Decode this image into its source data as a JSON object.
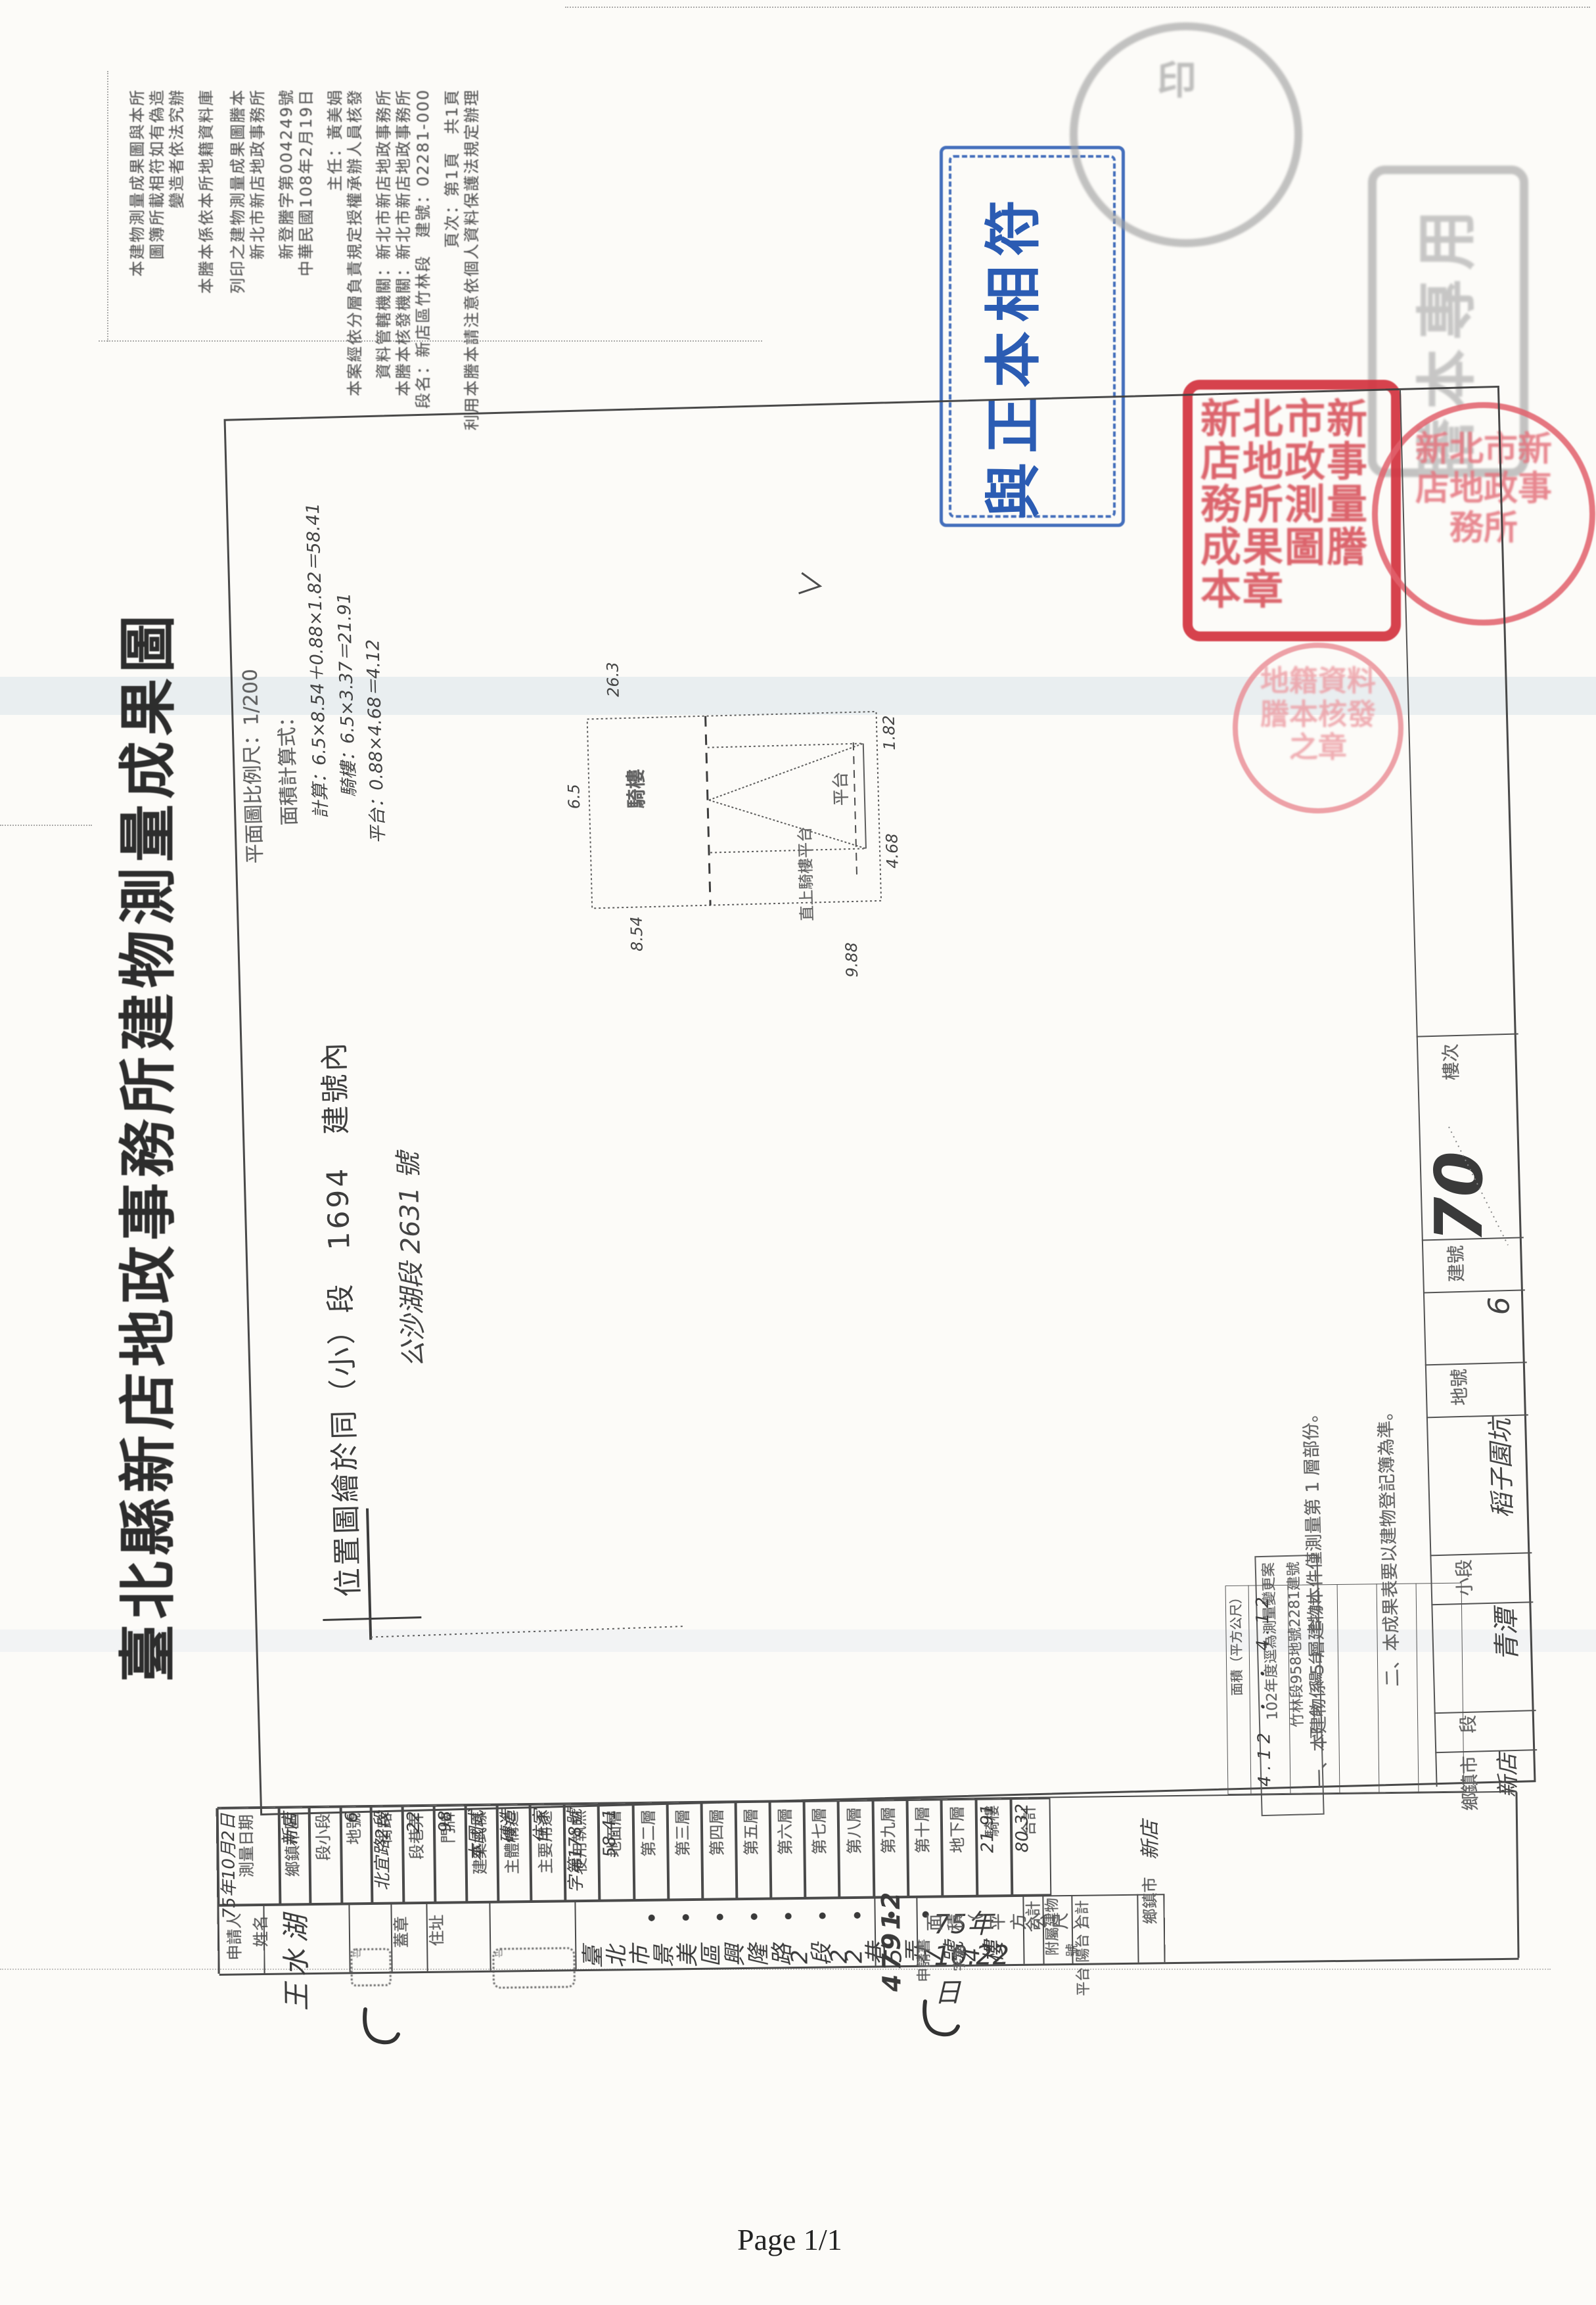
{
  "footer": {
    "page_indicator": "Page 1/1"
  },
  "blue_stamp": {
    "text": "與正本相符",
    "color": "#2b5cb3"
  },
  "title": "臺北縣新店地政事務所建物測量成果圖",
  "certification": {
    "lines": [
      "本建物測量成果圖與本所",
      "圖簿所載相符如有偽造",
      "變造者依法究辦",
      "本謄本係依本所地籍資料庫",
      "列印之建物測量成果圖謄本",
      "新北市新店地政事務所",
      "新登謄字第004249號",
      "中華民國108年2月19日",
      "主任：黃美娟",
      "本案經依分層負責規定授權承辦人員核發",
      "資料管轄機關：新北市新店地政事務所",
      "本謄本核發機關：新北市新店地政事務所",
      "段名：新店區竹林段　建號：02281-000",
      "頁次：第1頁　共1頁",
      "利用本謄本請注意依個人資料保護法規定辦理"
    ]
  },
  "map": {
    "scale_label": "平面圖比例尺：1/200",
    "calc_title": "面積計算式：",
    "calc_lines": [
      "計算：6.5×8.54＋0.88×1.82＝58.41",
      "騎樓：6.5×3.37＝21.91",
      "平台：0.88×4.68＝4.12"
    ],
    "location_line": "位置圖繪於同（小）段　1694　建號內",
    "location_hand": "公沙湖段 2631 號",
    "notes": [
      "一、本建物係 5 層建物本件僅測量第 1 層部份。",
      "二、本成果表要以建物登記簿為準。"
    ],
    "note_box": [
      "102年度逕為測量變更案",
      "竹林段958地號2281建號"
    ],
    "check_mark": "＞"
  },
  "plan": {
    "labels": {
      "arcade": "騎樓",
      "platform": "平台",
      "stair": "直上騎樓平台"
    },
    "dims": {
      "top": "26.3",
      "left": "6.5",
      "bottom_left": "8.54",
      "bottom_right": "9.88",
      "right_top": "1.82",
      "right_mid": "4.68"
    }
  },
  "strip": {
    "cells": [
      {
        "label": "樓次",
        "value": ""
      },
      {
        "label": "建號",
        "value": "70"
      },
      {
        "label": "地號",
        "value": "6"
      },
      {
        "label": "小段",
        "value": "稻子園坑"
      },
      {
        "label": "段",
        "value": "青潭"
      },
      {
        "label": "鄉鎮市",
        "value": "新店"
      }
    ]
  },
  "table": {
    "fields": [
      {
        "label": "測量日期",
        "value": "75年10月2日"
      },
      {
        "label": "鄉鎮市區",
        "value": "新店"
      },
      {
        "label": "段小段",
        "value": ""
      },
      {
        "label": "地號",
        "value": "6"
      },
      {
        "label": "街路",
        "value": "北宜路2段"
      },
      {
        "label": "段巷弄",
        "value": "22"
      },
      {
        "label": "門牌",
        "value": "98"
      },
      {
        "label": "建築式樣",
        "value": "本國式"
      },
      {
        "label": "主體構造",
        "value": "磚造"
      },
      {
        "label": "主要用途",
        "value": "住家"
      },
      {
        "label": "使用執照",
        "value": "字第178號"
      },
      {
        "label": "地面層",
        "value": "58.41"
      },
      {
        "label": "第二層",
        "value": "·"
      },
      {
        "label": "第三層",
        "value": "·"
      },
      {
        "label": "第四層",
        "value": "·"
      },
      {
        "label": "第五層",
        "value": "·"
      },
      {
        "label": "第六層",
        "value": "·"
      },
      {
        "label": "第七層",
        "value": "·"
      },
      {
        "label": "第八層",
        "value": "·"
      },
      {
        "label": "第九層",
        "value": "·"
      },
      {
        "label": "第十層",
        "value": "·"
      },
      {
        "label": "地下層",
        "value": ""
      },
      {
        "label": "騎樓",
        "value": "21.91"
      },
      {
        "label": "合計",
        "value": "80.32"
      }
    ],
    "area_unit_label": "面積（平方公尺）",
    "total_label": "合計",
    "annex": {
      "group_label": "附屬建物",
      "col_labels": "平台 陽台 合計",
      "unit_label": "面積（平方公尺）",
      "values": "4.12 ・ ・ 4.12"
    },
    "township": {
      "label": "鄉鎮市",
      "value": "新店"
    },
    "applicant": {
      "group_label": "申請人",
      "name_label": "姓名",
      "name_value": "王水湖",
      "seal_label": "蓋章",
      "address_label": "住址",
      "address_value": "臺北市景美區興隆路2段22巷5弄7號4樓"
    },
    "application": {
      "label": "申請書",
      "date": "75年10.22日",
      "no_prefix": "字第",
      "number": "21974",
      "no_suffix": "號"
    }
  },
  "seals": {
    "red_square": "新北市新店地政事務所測量成果圖謄本章",
    "red_circle_1": "新北市新店地政事務所",
    "red_circle_2": "地籍資料謄本核發之章",
    "gray_square": "謄本專用",
    "gray_circle": "印",
    "ink_seal_1": "印",
    "ink_seal_2": "印"
  }
}
